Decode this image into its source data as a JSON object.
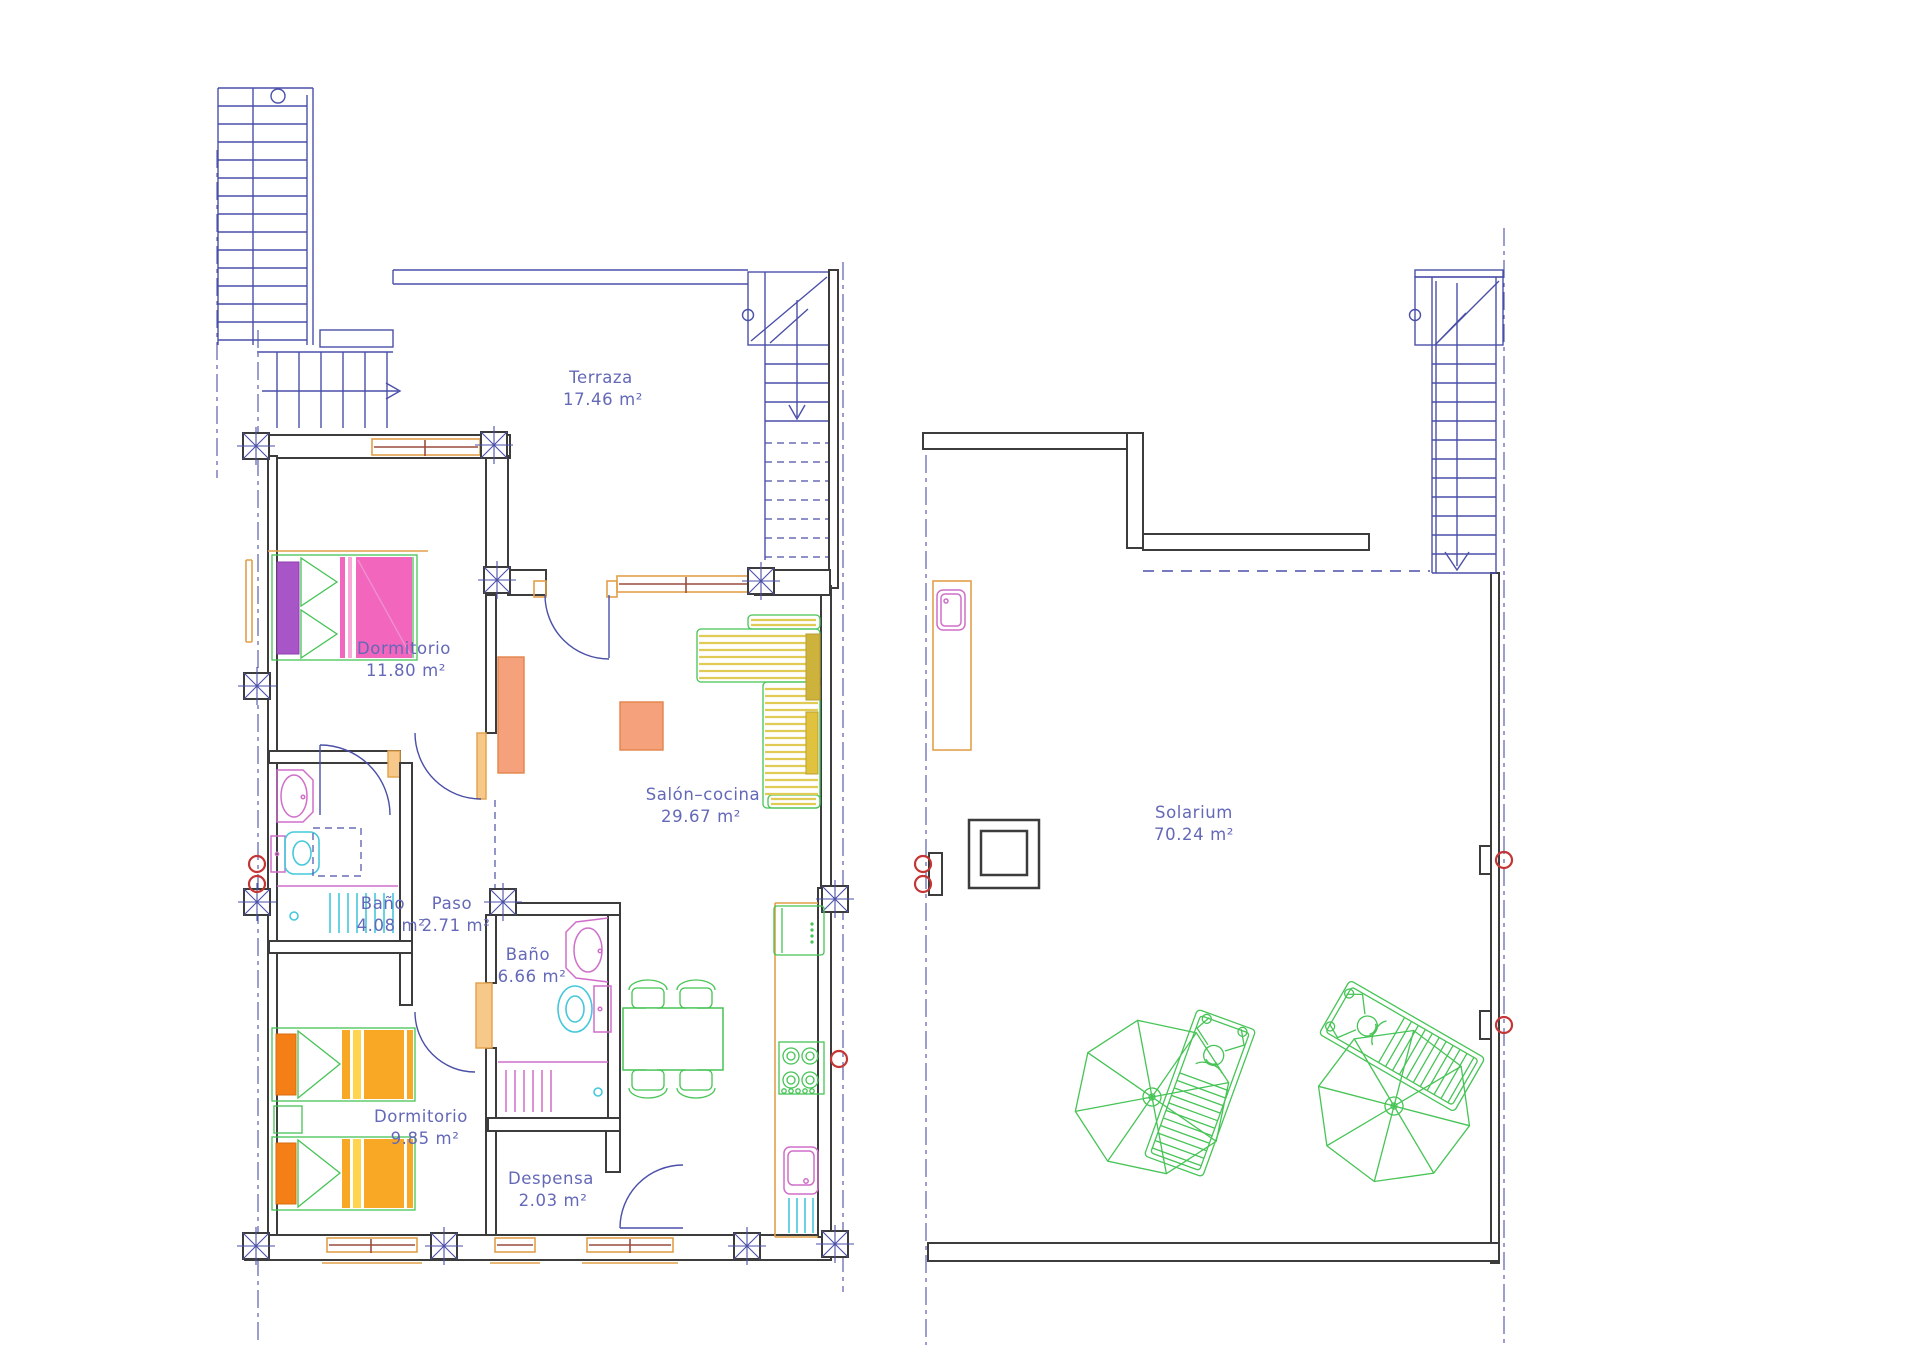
{
  "rooms": {
    "terraza": {
      "name": "Terraza",
      "area": "17.46 m²"
    },
    "dormitorio1": {
      "name": "Dormitorio",
      "area": "11.80 m²"
    },
    "salon_cocina": {
      "name": "Salón–cocina",
      "area": "29.67 m²"
    },
    "bano1": {
      "name": "Baño",
      "area": "4.08 m²"
    },
    "paso": {
      "name": "Paso",
      "area": "2.71 m²"
    },
    "bano2": {
      "name": "Baño",
      "area": "6.66 m²"
    },
    "dormitorio2": {
      "name": "Dormitorio",
      "area": "9.85 m²"
    },
    "despensa": {
      "name": "Despensa",
      "area": "2.03 m²"
    },
    "solarium": {
      "name": "Solarium",
      "area": "70.24 m²"
    }
  },
  "colors": {
    "wall": "#3c3c3c",
    "stairs_doors": "#4a4fa8",
    "window_frame": "#e2a04a",
    "window_glass": "#9a4d3f",
    "furniture_outline": "#46c455",
    "sanitary_magenta": "#cf6fc9",
    "sanitary_cyan": "#45c8dc",
    "plumbing_symbol": "#c43535",
    "bed_pink": "#f266bd",
    "bed_purple": "#a855c8",
    "bed_amber": "#f9a825",
    "sofa_yellow": "#fbf3bd",
    "table_yellow": "#f7d977",
    "furniture_salmon": "#f5a27c",
    "label_text": "#6468b8"
  }
}
